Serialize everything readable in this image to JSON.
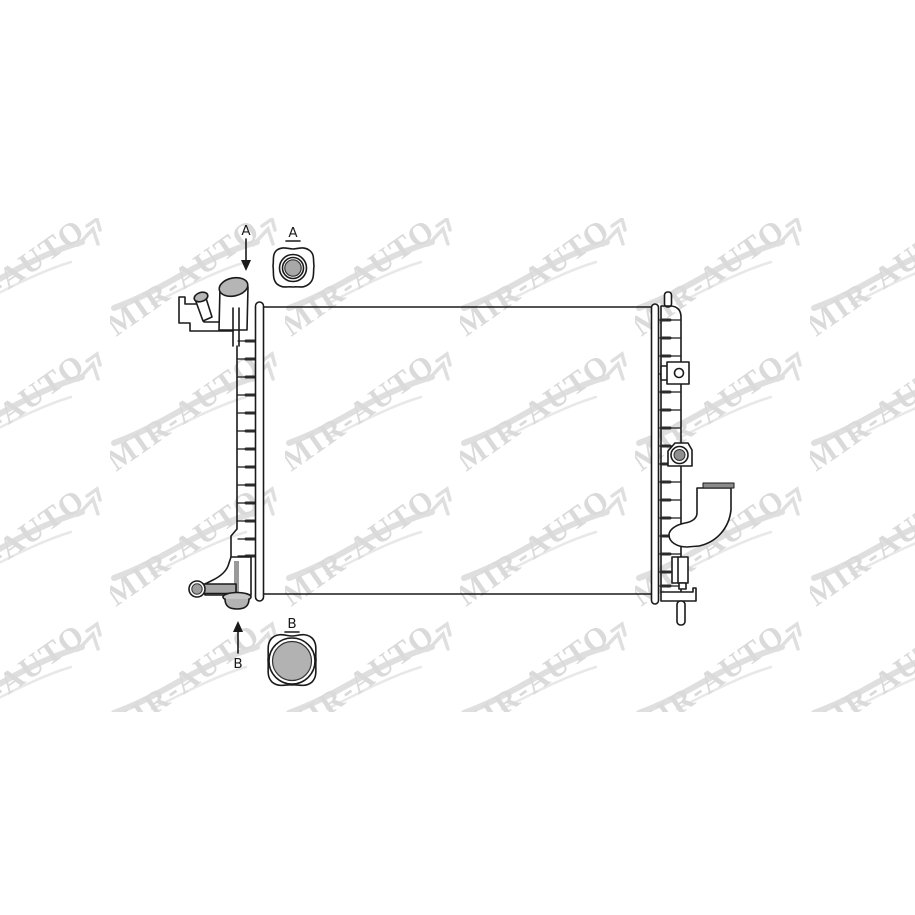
{
  "canvas": {
    "background": "#ffffff"
  },
  "watermark": {
    "text": "MIR-AUTO",
    "icon": "car-silhouette-swoosh-icon",
    "text_color": "#c2c2c2",
    "car_color": "#cacaca"
  },
  "drawing": {
    "subject": "radiator technical line drawing",
    "line_color": "#1a1a1a",
    "gray_fill": "#b3b3b3",
    "dark_gray": "#8c8c8c",
    "callout_a": {
      "arrow_label": "A",
      "detail_label": "A"
    },
    "callout_b": {
      "arrow_label": "B",
      "detail_label": "B"
    }
  }
}
